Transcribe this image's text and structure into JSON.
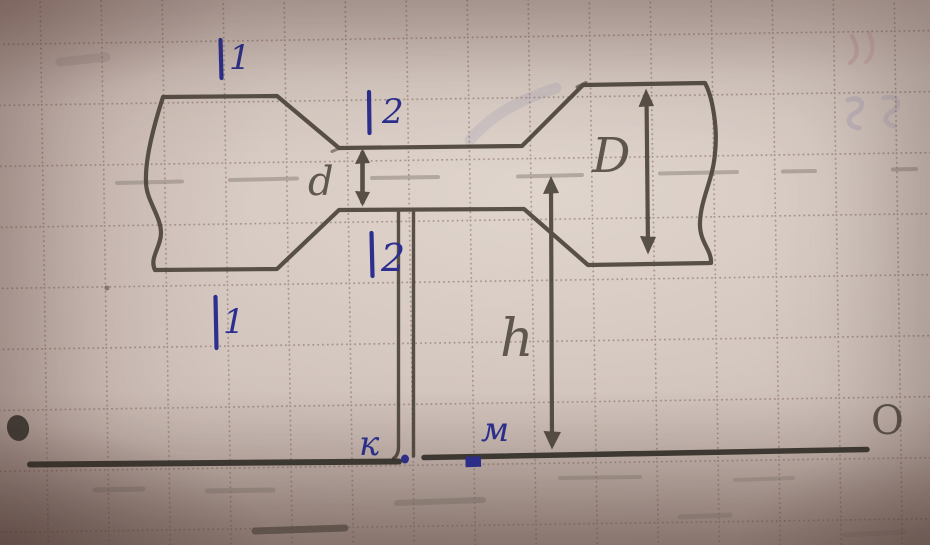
{
  "labels": {
    "section_1_top": "1",
    "section_2_top": "2",
    "section_2_bottom": "2",
    "section_1_bottom": "1",
    "dim_small_diameter": "d",
    "dim_large_diameter": "D",
    "dim_height": "h",
    "point_k": "к",
    "point_m": "м",
    "axis_end_right": "O"
  },
  "colors": {
    "ink_blue": "#2c2f8f",
    "pencil_dark": "#4a4339",
    "pencil_ground": "#33302a",
    "pencil_text": "#4f483e",
    "pencil_light": "#968c83",
    "grid_dots": "#7a5c52",
    "paper": "#cfc1ba"
  }
}
